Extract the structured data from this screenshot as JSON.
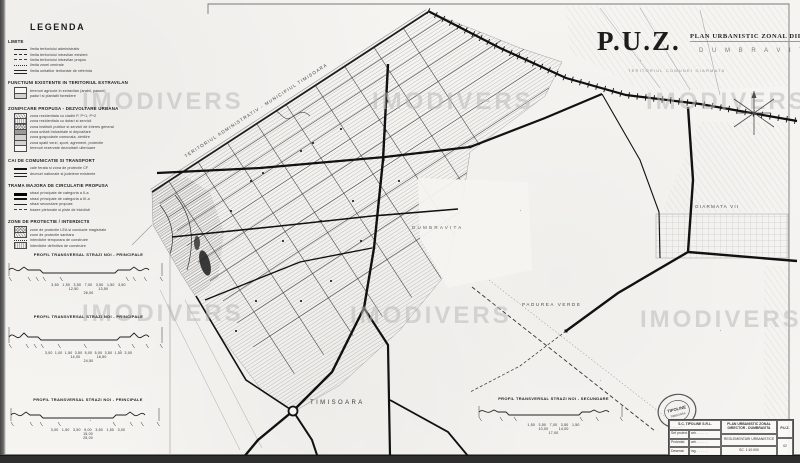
{
  "watermark": {
    "text": "IMODIVERS"
  },
  "header": {
    "puz": "P.U.Z.",
    "subtitle": "PLAN URBANISTIC ZONAL DIRECTOR",
    "locality": "D U M B R A V I T A",
    "territory_note": "TERITORIUL COMUNEI GIARMATA"
  },
  "legend": {
    "title": "LEGENDA",
    "sections": [
      {
        "title": "LIMITE",
        "items": [
          "limita teritoriului administrativ",
          "limita teritoriului intravilan existent",
          "limita teritoriului intravilan propus",
          "limita zonei centrale",
          "limita unitatilor teritoriale de referinta"
        ]
      },
      {
        "title": "FUNCTIUNI EXISTENTE IN TERITORIUL EXTRAVILAN",
        "items": [
          "terenuri agricole in extravilan (arabil, pasuni)",
          "paduri si plantatii forestiere"
        ]
      },
      {
        "title": "ZONIFICARE PROPUSA - DEZVOLTARE URBANA",
        "items": [
          "zona rezidentiala cu cladiri P, P+1, P+2",
          "zona rezidentiala cu dotari si servicii",
          "zona institutii publice si servicii de interes general",
          "zona unitati industriale si depozitare",
          "zona gospodarie comunala, cimitire",
          "zona spatii verzi, sport, agrement, protectie",
          "terenuri rezervate dezvoltarii ulterioare"
        ]
      },
      {
        "title": "CAI DE COMUNICATIE SI TRANSPORT",
        "items": [
          "cale ferata si zona de protectie CF",
          "drumuri nationale si judetene existente"
        ]
      },
      {
        "title": "TRAMA MAJORA DE CIRCULATIE PROPUSA",
        "items": [
          "strazi principale de categoria a II-a",
          "strazi principale de categoria a III-a",
          "strazi secundare propuse",
          "trasee pietonale si piste de biciclisti"
        ]
      },
      {
        "title": "ZONE DE PROTECTIE / INTERDICTII",
        "items": [
          "zone de protectie LEA si conducte magistrale",
          "zone de protectie sanitara",
          "interdictie temporara de construire",
          "interdictie definitiva de construire"
        ]
      }
    ]
  },
  "map_labels": {
    "territory_diagonal": "TERITORIUL ADMINISTRATIV - MUNICIPIUL TIMISOARA",
    "dumbravita": "DUMBRAVITA",
    "padurea_verde": "PADUREA VERDE",
    "timisoara": "TIMISOARA",
    "giarmata_vii": "GIARMATA VII"
  },
  "profiles": [
    {
      "title": "PROFIL TRANSVERSAL STRAZI NOI - PRINCIPALE",
      "dims1": "3,50   1,50   3,50   7,00   3,50   1,50   3,50",
      "dims2": "12,50                 13,50",
      "dims3": "26,00"
    },
    {
      "title": "PROFIL TRANSVERSAL STRAZI NOI - PRINCIPALE",
      "dims1": "3,00  1,00  1,50  3,50  5,00  5,00  3,50  1,50  3,00",
      "dims2": "14,00              16,50",
      "dims3": "24,50"
    },
    {
      "title": "PROFIL TRANSVERSAL STRAZI NOI - PRINCIPALE",
      "dims1": "3,00   1,50   3,50   9,00   3,50   1,50   3,00",
      "dims2": "15,00",
      "dims3": "25,00"
    },
    {
      "title": "PROFIL TRANSVERSAL STRAZI NOI - SECUNDARE",
      "dims1": "1,50   3,50   7,00   3,50   1,50",
      "dims2": "10,00         14,00",
      "dims3": "17,00"
    }
  ],
  "cartouche": {
    "company": "S.C. TIPOLINE S.R.L.",
    "rows": [
      {
        "label": "Sef proiect",
        "value": "arh. . . . . . ."
      },
      {
        "label": "Proiectat",
        "value": "arh. . . . . . ."
      },
      {
        "label": "Desenat",
        "value": "ing. . . . . . ."
      }
    ],
    "project_title": "PLAN URBANISTIC ZONAL DIRECTOR - DUMBRAVITA",
    "sheet_title": "REGLEMENTARI URBANISTICE",
    "scale": "SC. 1:10.000",
    "phase": "P.U.Z.",
    "sheet_no": "02"
  },
  "stamp": {
    "center": "TIPOLINE",
    "bottom": "TIMISOARA"
  }
}
